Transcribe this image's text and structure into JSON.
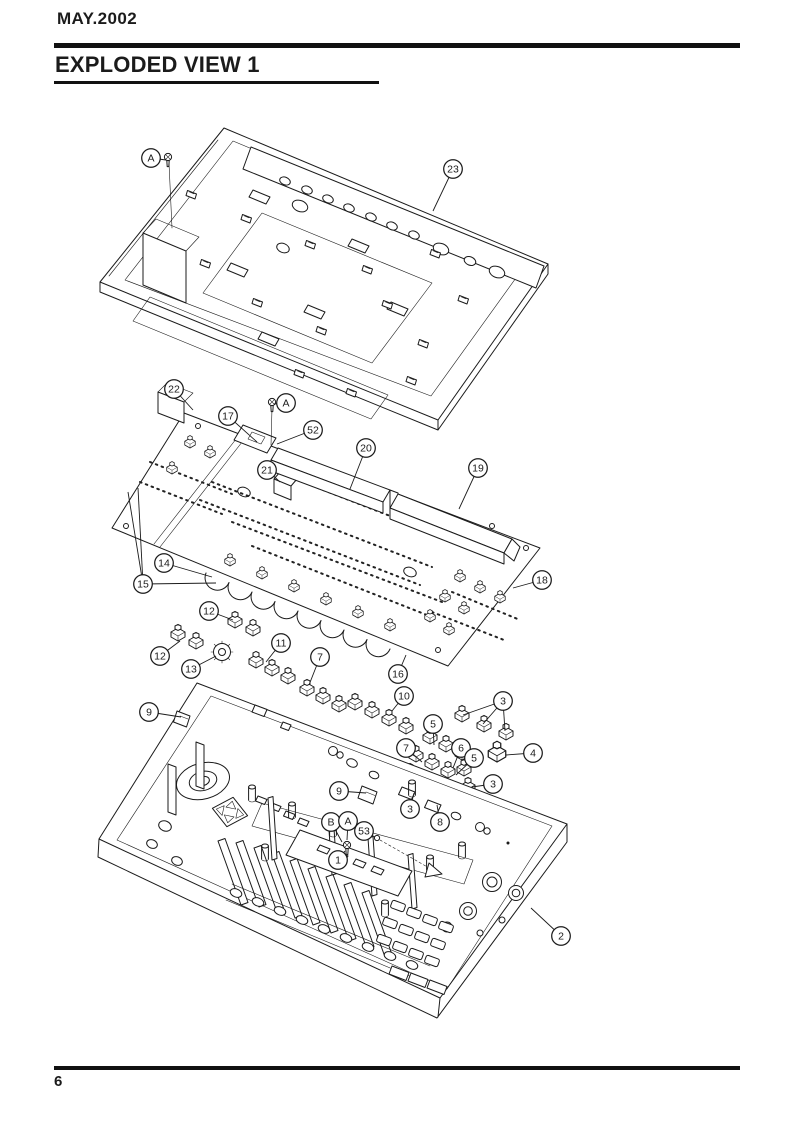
{
  "page": {
    "date_label": "MAY.2002",
    "title": "EXPLODED VIEW 1",
    "page_number": "6",
    "colors": {
      "ink": "#1b1b1b",
      "paper": "#ffffff"
    }
  },
  "diagram": {
    "type": "exploded-view-illustration",
    "description": "Exploded isometric line drawing: bottom chassis plate with rear connector flange (top), main circuit board with connector beams and sub-boards (middle), tact-switch and encoder assemblies, and the top case with jog wheel, cursor pad, fader slots, button holes and knobs (bottom).",
    "callouts": [
      {
        "label": "A",
        "x": 151,
        "y": 158,
        "targets": [
          [
            166,
            160
          ]
        ]
      },
      {
        "label": "23",
        "x": 453,
        "y": 169,
        "targets": [
          [
            433,
            211
          ]
        ]
      },
      {
        "label": "22",
        "x": 174,
        "y": 389,
        "targets": [
          [
            193,
            410
          ]
        ]
      },
      {
        "label": "17",
        "x": 228,
        "y": 416,
        "targets": [
          [
            257,
            442
          ]
        ]
      },
      {
        "label": "A",
        "x": 286,
        "y": 403,
        "targets": [
          [
            274,
            404
          ]
        ]
      },
      {
        "label": "52",
        "x": 313,
        "y": 430,
        "targets": [
          [
            277,
            444
          ]
        ]
      },
      {
        "label": "21",
        "x": 267,
        "y": 470,
        "targets": [
          [
            280,
            482
          ]
        ]
      },
      {
        "label": "20",
        "x": 366,
        "y": 448,
        "targets": [
          [
            350,
            489
          ]
        ]
      },
      {
        "label": "19",
        "x": 478,
        "y": 468,
        "targets": [
          [
            459,
            509
          ]
        ]
      },
      {
        "label": "14",
        "x": 164,
        "y": 563,
        "targets": [
          [
            212,
            577
          ]
        ]
      },
      {
        "label": "15",
        "x": 143,
        "y": 584,
        "targets": [
          [
            128,
            492
          ],
          [
            138,
            488
          ],
          [
            216,
            583
          ]
        ]
      },
      {
        "label": "18",
        "x": 542,
        "y": 580,
        "targets": [
          [
            513,
            588
          ]
        ]
      },
      {
        "label": "12",
        "x": 209,
        "y": 611,
        "targets": [
          [
            233,
            620
          ]
        ]
      },
      {
        "label": "12",
        "x": 160,
        "y": 656,
        "targets": [
          [
            180,
            641
          ]
        ]
      },
      {
        "label": "13",
        "x": 191,
        "y": 669,
        "targets": [
          [
            216,
            656
          ]
        ]
      },
      {
        "label": "11",
        "x": 281,
        "y": 643,
        "targets": [
          [
            266,
            662
          ]
        ]
      },
      {
        "label": "7",
        "x": 320,
        "y": 657,
        "targets": [
          [
            309,
            685
          ]
        ]
      },
      {
        "label": "16",
        "x": 398,
        "y": 674,
        "targets": [
          [
            406,
            655
          ]
        ]
      },
      {
        "label": "10",
        "x": 404,
        "y": 696,
        "targets": [
          [
            392,
            711
          ]
        ]
      },
      {
        "label": "3",
        "x": 503,
        "y": 701,
        "targets": [
          [
            463,
            715
          ],
          [
            483,
            724
          ],
          [
            505,
            731
          ]
        ]
      },
      {
        "label": "5",
        "x": 433,
        "y": 724,
        "targets": [
          [
            434,
            745
          ]
        ]
      },
      {
        "label": "7",
        "x": 406,
        "y": 748,
        "targets": [
          [
            422,
            762
          ]
        ]
      },
      {
        "label": "6",
        "x": 461,
        "y": 748,
        "targets": [
          [
            453,
            768
          ]
        ]
      },
      {
        "label": "5",
        "x": 474,
        "y": 758,
        "targets": [
          [
            456,
            775
          ]
        ]
      },
      {
        "label": "4",
        "x": 533,
        "y": 753,
        "targets": [
          [
            506,
            755
          ]
        ]
      },
      {
        "label": "9",
        "x": 149,
        "y": 712,
        "targets": [
          [
            181,
            717
          ]
        ]
      },
      {
        "label": "9",
        "x": 339,
        "y": 791,
        "targets": [
          [
            366,
            793
          ]
        ]
      },
      {
        "label": "3",
        "x": 493,
        "y": 784,
        "targets": [
          [
            472,
            787
          ]
        ]
      },
      {
        "label": "3",
        "x": 410,
        "y": 809,
        "targets": [
          [
            414,
            793
          ]
        ]
      },
      {
        "label": "8",
        "x": 440,
        "y": 822,
        "targets": [
          [
            437,
            805
          ]
        ]
      },
      {
        "label": "B",
        "x": 331,
        "y": 822,
        "targets": [
          [
            342,
            842
          ]
        ]
      },
      {
        "label": "A",
        "x": 348,
        "y": 821,
        "targets": [
          [
            347,
            840
          ]
        ]
      },
      {
        "label": "53",
        "x": 364,
        "y": 831,
        "targets": [
          [
            375,
            837
          ]
        ]
      },
      {
        "label": "1",
        "x": 338,
        "y": 860,
        "targets": [
          [
            345,
            851
          ]
        ]
      },
      {
        "label": "2",
        "x": 561,
        "y": 936,
        "targets": [
          [
            531,
            908
          ]
        ]
      }
    ]
  }
}
